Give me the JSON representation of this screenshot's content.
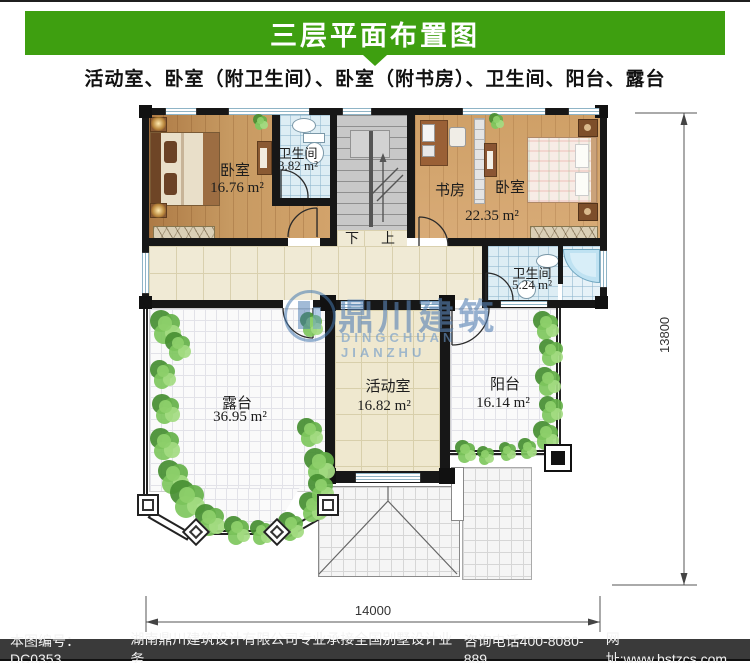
{
  "header": {
    "title": "三层平面布置图",
    "subtitle": "活动室、卧室（附卫生间）、卧室（附书房）、卫生间、阳台、露台"
  },
  "rooms": {
    "bedroom_left": {
      "name": "卧室",
      "area": "16.76 m²"
    },
    "bathroom_top": {
      "name": "卫生间",
      "area": "3.82 m²"
    },
    "study": {
      "name": "书房"
    },
    "bedroom_right": {
      "name": "卧室",
      "area": "22.35 m²"
    },
    "bathroom_mid": {
      "name": "卫生间",
      "area": "5.24 m²"
    },
    "terrace": {
      "name": "露台",
      "area": "36.95 m²"
    },
    "activity_room": {
      "name": "活动室",
      "area": "16.82 m²"
    },
    "balcony": {
      "name": "阳台",
      "area": "16.14 m²"
    }
  },
  "stairs": {
    "down_label": "下",
    "up_label": "上"
  },
  "watermark": {
    "logo_cn": "鼎川建筑",
    "logo_en": "DINGCHUAN JIANZHU"
  },
  "dimensions": {
    "bottom_width": "14000",
    "right_height": "13800"
  },
  "footer": {
    "plan_number": "本图编号：DC0353",
    "company": "湖南鼎川建筑设计有限公司专业承接全国别墅设计业务",
    "phone": "咨询电话400-8080-889",
    "website": "网址:www.bstzcs.com"
  },
  "colors": {
    "banner_green": "#3e9f10",
    "footer_bg": "#3a3a3a",
    "wall_black": "#171717",
    "watermark_blue": "#6e9cc8"
  }
}
